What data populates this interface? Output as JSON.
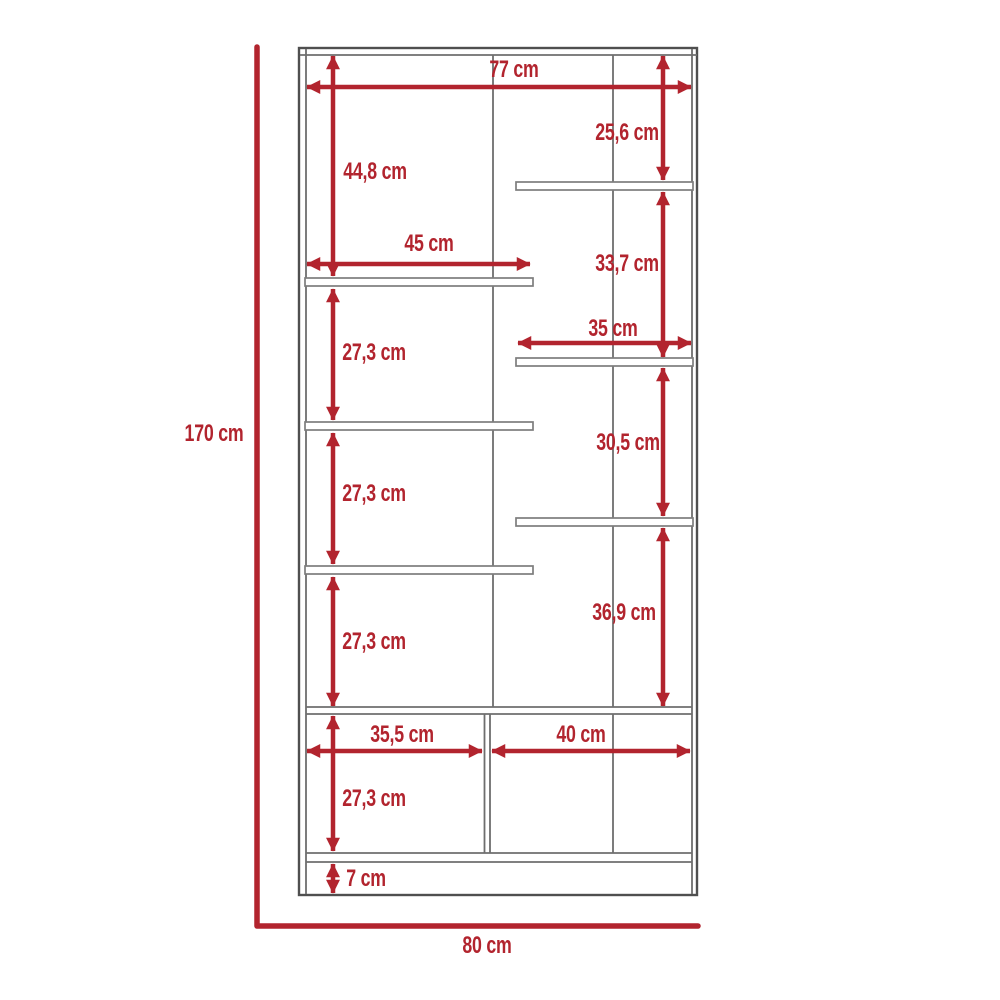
{
  "colors": {
    "accent_red": "#b2242e",
    "cabinet_outline_gray": "#4f4f4f",
    "divider_gray": "#6e6e6e",
    "shelf_border_gray": "#7d7d7d",
    "background": "#ffffff"
  },
  "diagram": {
    "kind": "furniture-dimension-drawing",
    "overall": {
      "height_label": "170 cm",
      "width_label": "80 cm"
    },
    "dims": {
      "top_inner_width": "77 cm",
      "upper_left_height": "44,8 cm",
      "upper_right_height": "25,6 cm",
      "left_shelf_width": "45 cm",
      "right_gap_2_height": "33,7 cm",
      "right_shelf_width": "35 cm",
      "left_gap_1_height": "27,3 cm",
      "right_gap_3_height": "30,5 cm",
      "left_gap_2_height": "27,3 cm",
      "right_gap_4_height": "36,9 cm",
      "left_gap_3_height": "27,3 cm",
      "bottom_left_width": "35,5 cm",
      "bottom_right_width": "40 cm",
      "bottom_left_height": "27,3 cm",
      "base_height": "7 cm"
    }
  }
}
